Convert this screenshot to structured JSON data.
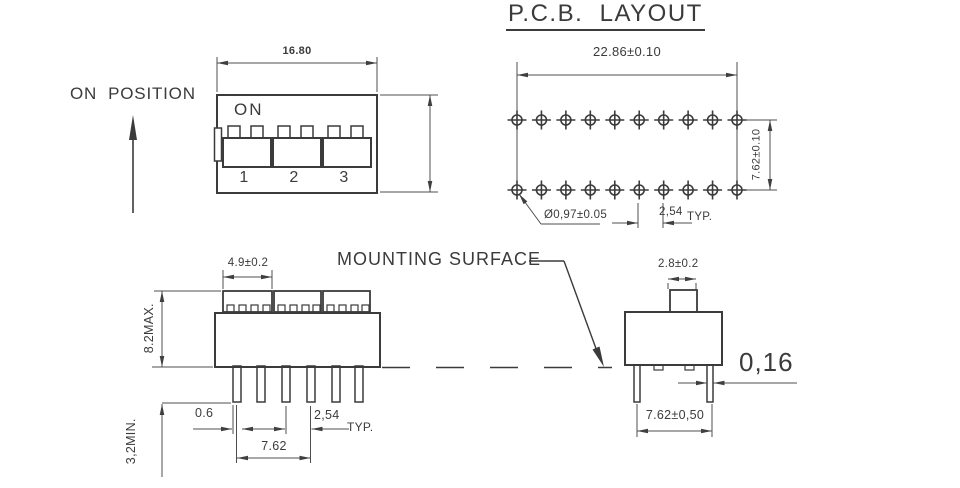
{
  "title": "P.C.B.  LAYOUT",
  "colors": {
    "line": "#3b3b3b",
    "dim": "#4f4f4f",
    "text": "#3b3b3b",
    "background": "#ffffff"
  },
  "top_view": {
    "label_on_position": "ON  POSITION",
    "dim_body_width": "16.80",
    "on_label": "ON",
    "switch_numbers": [
      "1",
      "2",
      "3"
    ]
  },
  "pcb_layout": {
    "dim_overall_width": "22.86±0.10",
    "dim_row_spacing": "7.62±0.10",
    "dim_hole_diameter": "Ø0,97±0.05",
    "dim_hole_pitch": "2,54",
    "dim_hole_pitch_suffix": "TYP.",
    "holes_per_row": 10,
    "rows": 2
  },
  "front_view": {
    "dim_cap_width": "4.9±0.2",
    "dim_body_height": "8.2MAX.",
    "dim_pin_length": "3,2MIN.",
    "dim_pin_width": "0.6",
    "dim_pin_pitch": "2,54",
    "dim_pin_pitch_suffix": "TYP.",
    "dim_pin_group_span": "7.62"
  },
  "side_view": {
    "label_mounting_surface": "MOUNTING SURFACE",
    "dim_actuator_width": "2.8±0.2",
    "dim_pin_thickness": "0,16",
    "dim_pin_row_span": "7.62±0,50"
  }
}
